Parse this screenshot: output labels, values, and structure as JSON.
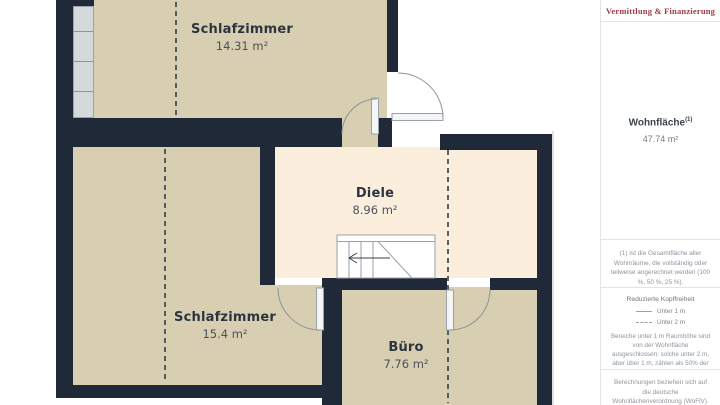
{
  "plan": {
    "rooms": [
      {
        "id": "bedroom-top",
        "name": "Schlafzimmer",
        "area": "14.31 m²"
      },
      {
        "id": "hallway",
        "name": "Diele",
        "area": "8.96 m²"
      },
      {
        "id": "bedroom-bottom",
        "name": "Schlafzimmer",
        "area": "15.4 m²"
      },
      {
        "id": "office",
        "name": "Büro",
        "area": "7.76 m²"
      }
    ],
    "colors": {
      "wall": "#1f2937",
      "room_fill": "#d8ceb2",
      "hallway_fill": "#fbeedd",
      "window_glazing": "#d5d9dc",
      "door_line": "#8d939a",
      "headroom_dash": "#343e4a"
    }
  },
  "sidebar": {
    "brand_tagline": "Vermittlung & Finanzierung",
    "living_area": {
      "label": "Wohnfläche",
      "superscript": "(1)",
      "value": "47.74 m²"
    },
    "footnote": "(1) Ist die Gesamtfläche aller Wohnräume, die vollständig oder teilweise angerechnet werden (100 %, 50 %, 25 %).",
    "headroom": {
      "title": "Reduzierte Kopffreiheit",
      "items": [
        {
          "style": "solid",
          "label": "Unter 1 m"
        },
        {
          "style": "dashed",
          "label": "Unter 2 m"
        }
      ],
      "description": "Bereiche unter 1 m Raumhöhe sind von der Wohnfläche ausgeschlossen; solche unter 2 m, aber über 1 m, zählen als 50% der Wohnfläche"
    },
    "disclaimer": "Berechnungen beziehen sich auf die deutsche Wohnflächenverordnung (WoFlV). Maße sind ungefähre Angaben"
  }
}
